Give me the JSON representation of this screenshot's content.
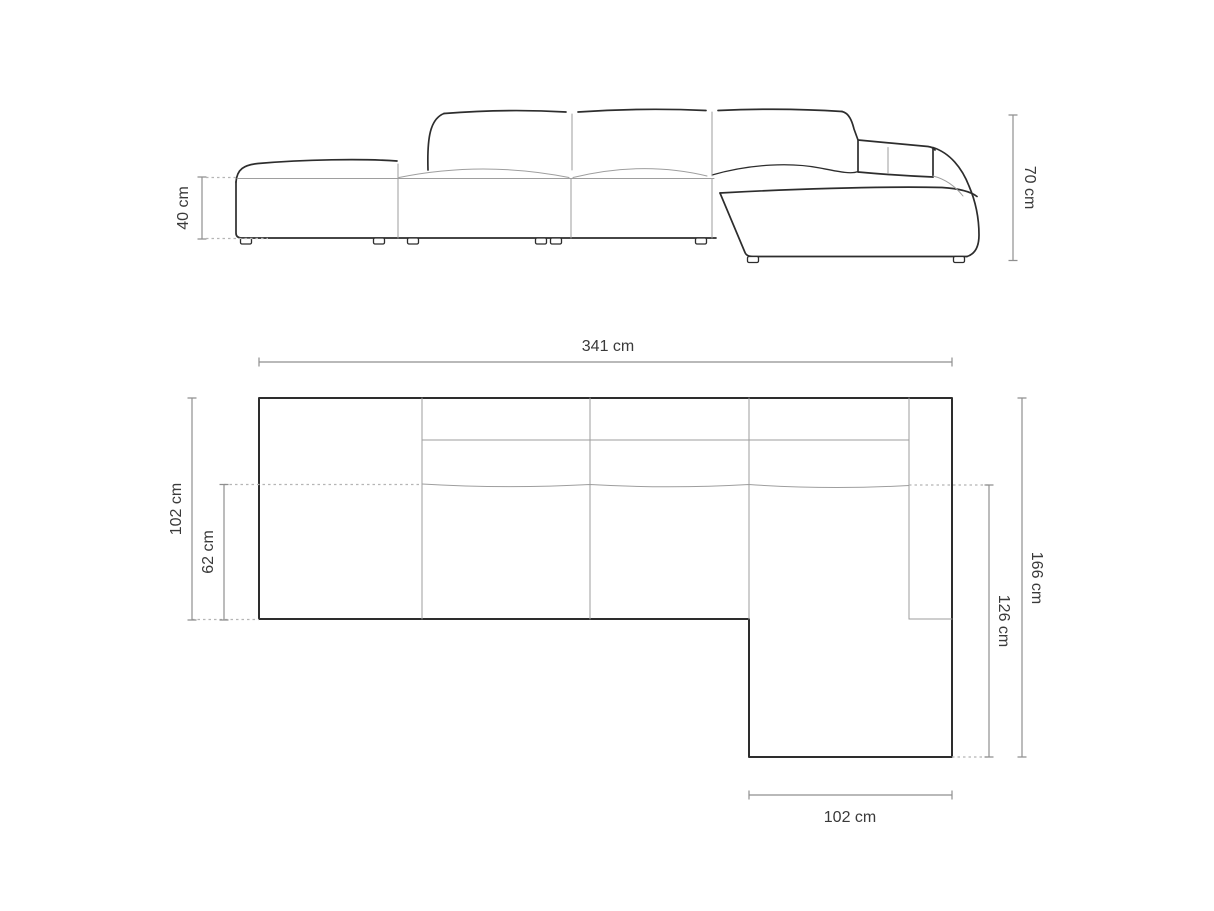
{
  "diagram": {
    "subject": "modular-corner-sofa-dimension-drawing",
    "background": "#ffffff"
  },
  "colors": {
    "outline": "#2d2d2d",
    "inner_seam": "#9e9e9e",
    "dimension_line": "#8f8f8f",
    "dashed_line": "#b5b5b5",
    "label_text": "#3a3a3a"
  },
  "front_view": {
    "name": "front-elevation",
    "dimensions": [
      {
        "id": "seat-height",
        "label": "40 cm",
        "orientation": "vertical-left"
      },
      {
        "id": "total-height",
        "label": "70 cm",
        "orientation": "vertical-right"
      }
    ]
  },
  "plan_view": {
    "name": "top-plan",
    "dimensions": [
      {
        "id": "total-width",
        "label": "341 cm",
        "orientation": "horizontal-top"
      },
      {
        "id": "body-depth",
        "label": "102 cm",
        "orientation": "vertical-left-outer"
      },
      {
        "id": "seat-depth",
        "label": "62 cm",
        "orientation": "vertical-left-inner"
      },
      {
        "id": "right-side-length",
        "label": "166 cm",
        "orientation": "vertical-right-outer"
      },
      {
        "id": "chaise-extension",
        "label": "126 cm",
        "orientation": "vertical-right-inner"
      },
      {
        "id": "chaise-width",
        "label": "102 cm",
        "orientation": "horizontal-bottom"
      }
    ]
  }
}
